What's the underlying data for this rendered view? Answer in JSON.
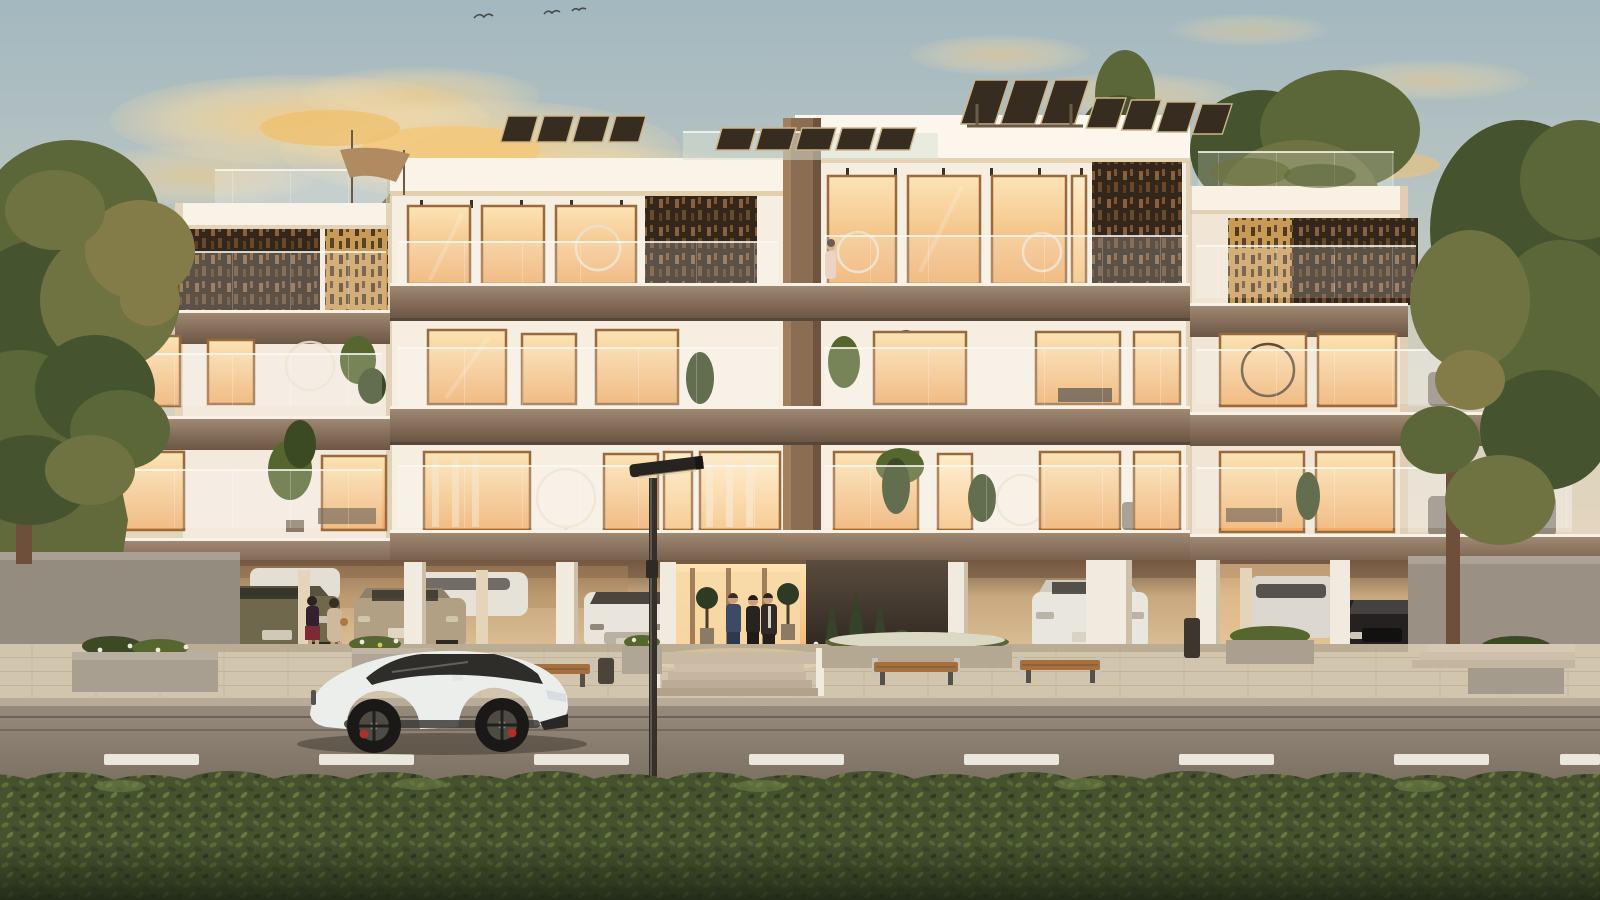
{
  "scene": {
    "type": "architectural-render",
    "description": "Modern three-storey apartment complex at sunset with rooftop solar panels, bronze lattice balcony screens, glass balustrades, warm-lit interiors, ground-level parking with residents and cars, a white sports sedan on the street, a street lamp, and a green hedge in the foreground",
    "time_of_day": "sunset"
  },
  "inventory": {
    "building": {
      "floors_above_parking": 3,
      "wings": 2,
      "solar_panel_groups": 4,
      "lattice_screens": 6,
      "balcony_bands": 3,
      "roof_features": [
        "solar-panels",
        "glass-roof-terrace",
        "shade-sail"
      ]
    },
    "vehicles": {
      "street_car": "white sports sedan",
      "parked_cars": [
        "olive sedan (rear)",
        "beige sedan (rear)",
        "white sedan (front)",
        "white sedan (rear)",
        "white suv",
        "black car (front)",
        "white car (partial)",
        "white car (partial)"
      ]
    },
    "people": {
      "women_in_parking": 2,
      "men_at_entrance": 3,
      "balcony_resident": 1
    },
    "street_furniture": {
      "benches": 3,
      "planters": 6,
      "lamp_posts": 1,
      "trash_bins": 2,
      "lane_dashes": 8
    },
    "nature": {
      "tree_clusters": 3,
      "hedge": "foreground full width",
      "birds": 3
    }
  },
  "colors": {
    "sky_top": "#a3b8bf",
    "sky_mid": "#c7ccc4",
    "sky_horizon": "#ecdcc5",
    "cloud": "#f4cd84",
    "haze": "#f7d3a0",
    "facade": "#f6eee1",
    "facade_bright": "#fcf6ec",
    "fascia_light": "#a18a73",
    "fascia_dark": "#6b5645",
    "lattice": "#33261a",
    "lattice_gold": "#c89a58",
    "frame": "#9a6a3c",
    "window_glow_top": "#fce4b6",
    "window_glow_bottom": "#eeab66",
    "parking_glow": "#ffdfae",
    "dark_wall": "#40352a",
    "pavement": "#d2c5ae",
    "road_top": "#968a7c",
    "road_bottom": "#786d5f",
    "lane_dash": "#eae7dc",
    "hedge": "#46522e",
    "hedge_light": "#68793f",
    "tree_dark": "#46532f",
    "car_white": "#eceeec",
    "caliper_red": "#ad3126",
    "lamp": "#35302b"
  }
}
